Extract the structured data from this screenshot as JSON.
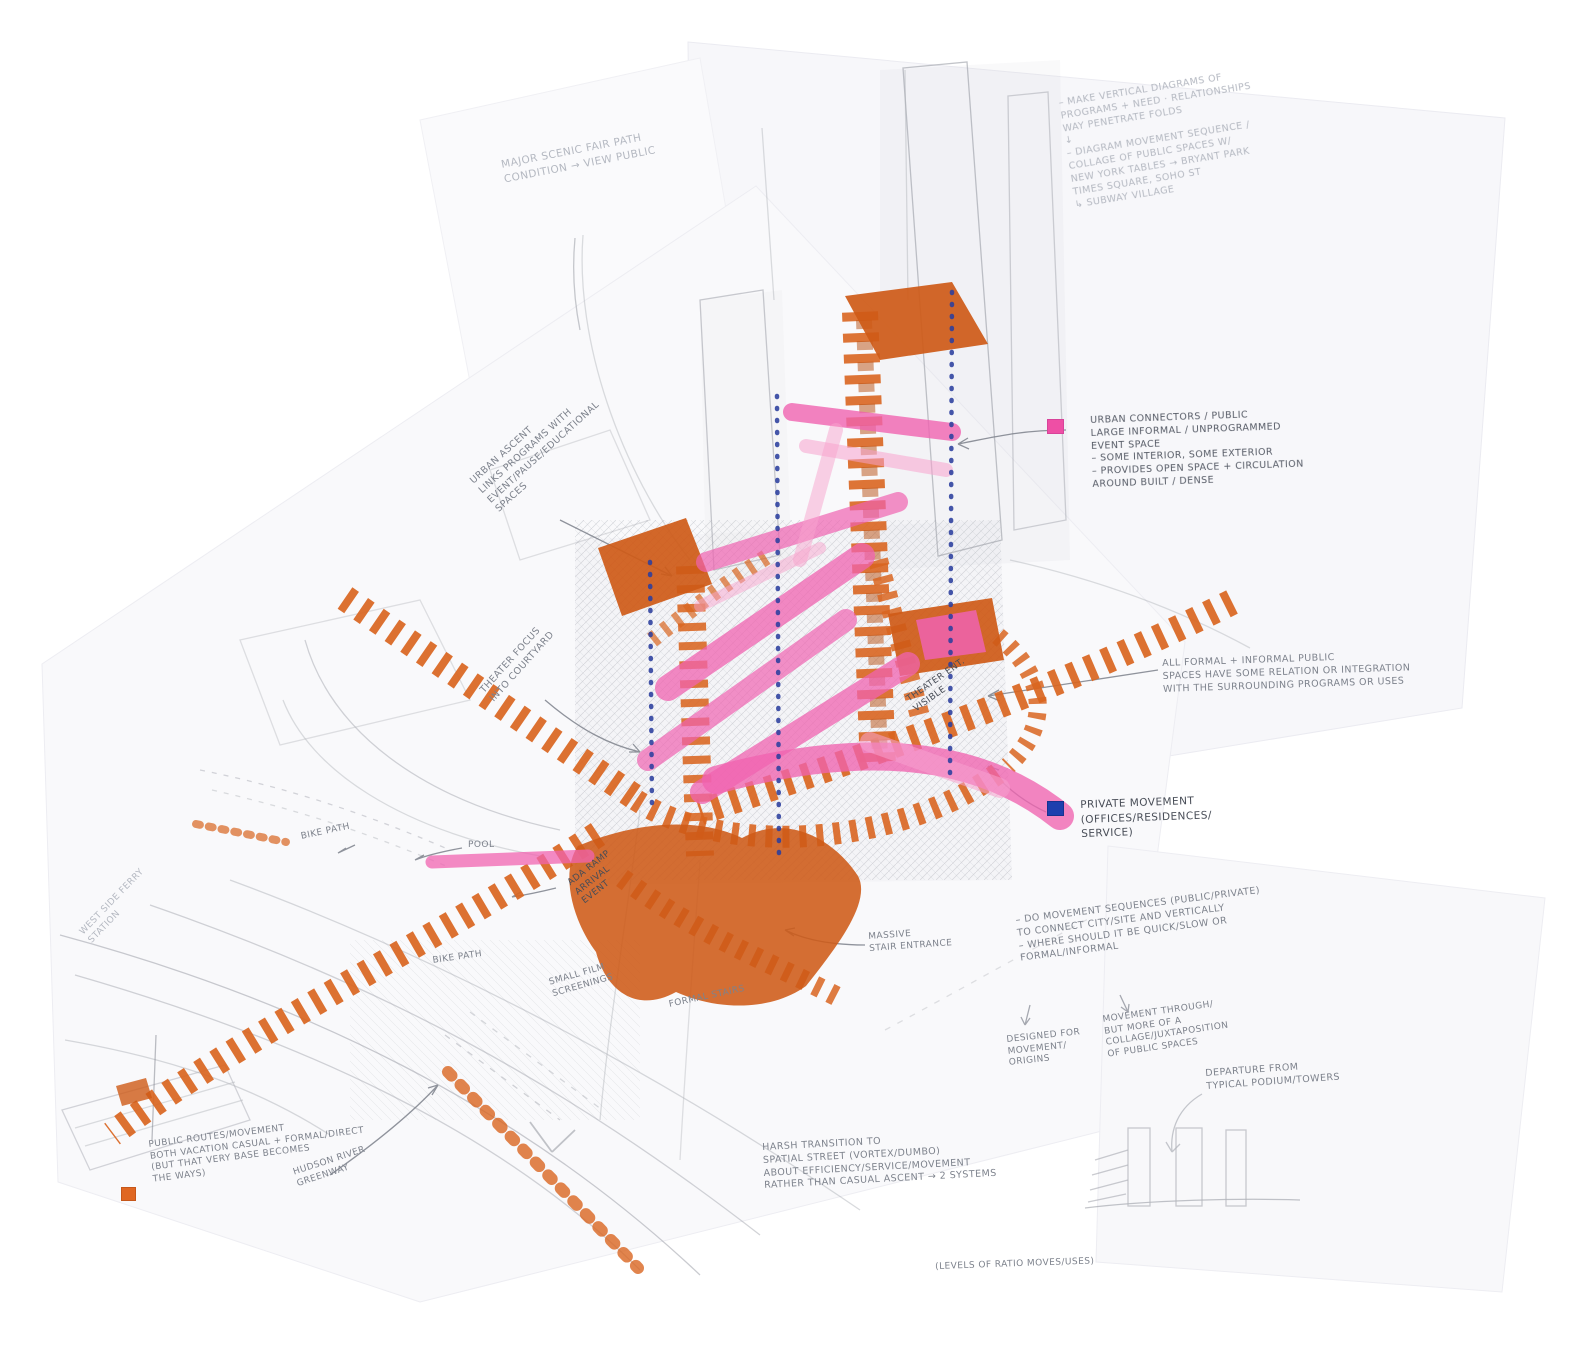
{
  "colors": {
    "marker_orange": "#D96520",
    "marker_orange_dark": "#B84E10",
    "marker_pink": "#F063B0",
    "marker_pink_light": "#F8A3CE",
    "dotted_blue": "#2B3F9E",
    "pencil_gray": "#8E9096",
    "legend_pink_swatch": "#EE4FA5",
    "legend_blue_swatch": "#1D3FAE",
    "legend_orange_swatch": "#E06722"
  },
  "notes": {
    "top_left": {
      "text": "MAJOR SCENIC FAIR PATH\nCONDITION → VIEW PUBLIC"
    },
    "top_right": {
      "text": "– MAKE VERTICAL DIAGRAMS OF\n   PROGRAMS + NEED · RELATIONSHIPS\n   WAY PENETRATE FOLDS\n          ↓\n– DIAGRAM MOVEMENT SEQUENCE /\n   COLLAGE OF PUBLIC SPACES W/\n   NEW YORK TABLES → BRYANT PARK\n      TIMES SQUARE, SOHO ST\n       ↳ SUBWAY VILLAGE"
    },
    "urban_connectors": {
      "text": "URBAN CONNECTORS / PUBLIC\nLARGE INFORMAL / UNPROGRAMMED\nEVENT SPACE\n– SOME INTERIOR, SOME EXTERIOR\n– PROVIDES OPEN SPACE + CIRCULATION\n   AROUND BUILT / DENSE"
    },
    "all_formal": {
      "text": "ALL FORMAL + INFORMAL PUBLIC\nSPACES HAVE SOME RELATION OR INTEGRATION\nWITH THE SURROUNDING PROGRAMS OR USES"
    },
    "private_movement": {
      "text": "PRIVATE MOVEMENT\n(OFFICES/RESIDENCES/\n   SERVICE)"
    },
    "movement_sequences": {
      "text": "– DO MOVEMENT SEQUENCES (PUBLIC/PRIVATE)\n   TO CONNECT CITY/SITE AND VERTICALLY\n– WHERE SHOULD IT BE QUICK/SLOW OR\n   FORMAL/INFORMAL"
    },
    "ms_sub_left": {
      "text": "DESIGNED FOR\nMOVEMENT/\nORIGINS"
    },
    "ms_sub_right": {
      "text": "MOVEMENT THROUGH/\nBUT MORE OF A\nCOLLAGE/JUXTAPOSITION\nOF PUBLIC SPACES"
    },
    "departure": {
      "text": "DEPARTURE FROM\nTYPICAL PODIUM/TOWERS"
    },
    "harsh_transition": {
      "text": "HARSH TRANSITION TO\nSPATIAL STREET (VORTEX/DUMBO)\nABOUT EFFICIENCY/SERVICE/MOVEMENT\nRATHER THAN CASUAL ASCENT → 2 SYSTEMS"
    },
    "levels_note": {
      "text": "(LEVELS OF RATIO MOVES/USES)"
    },
    "urban_ascent": {
      "text": "URBAN ASCENT\nLINKS PROGRAMS WITH\nEVENT/PAUSE/EDUCATIONAL\nSPACES"
    },
    "theater_focus": {
      "text": "THEATER FOCUS\nINTO COURTYARD"
    },
    "bike_path_1": {
      "text": "BIKE PATH"
    },
    "bike_path_2": {
      "text": "BIKE PATH"
    },
    "pool": {
      "text": "POOL"
    },
    "small_film": {
      "text": "SMALL FILM\nSCREENINGS"
    },
    "ada_ramp": {
      "text": "ADA RAMP\nARRIVAL\nEVENT"
    },
    "massive_stair": {
      "text": "MASSIVE\nSTAIR ENTRANCE"
    },
    "formal_stairs": {
      "text": "FORMAL STAIRS"
    },
    "west_side_ferry": {
      "text": "WEST SIDE FERRY\nSTATION"
    },
    "hudson_greenway": {
      "text": "HUDSON RIVER\nGREENWAY"
    },
    "orange_legend": {
      "text": "PUBLIC ROUTES/MOVEMENT\nBOTH VACATION CASUAL + FORMAL/DIRECT\n(BUT THAT VERY BASE BECOMES\n   THE WAYS)"
    },
    "theater_ent": {
      "text": "THEATER ENT.\nVISIBLE"
    }
  }
}
